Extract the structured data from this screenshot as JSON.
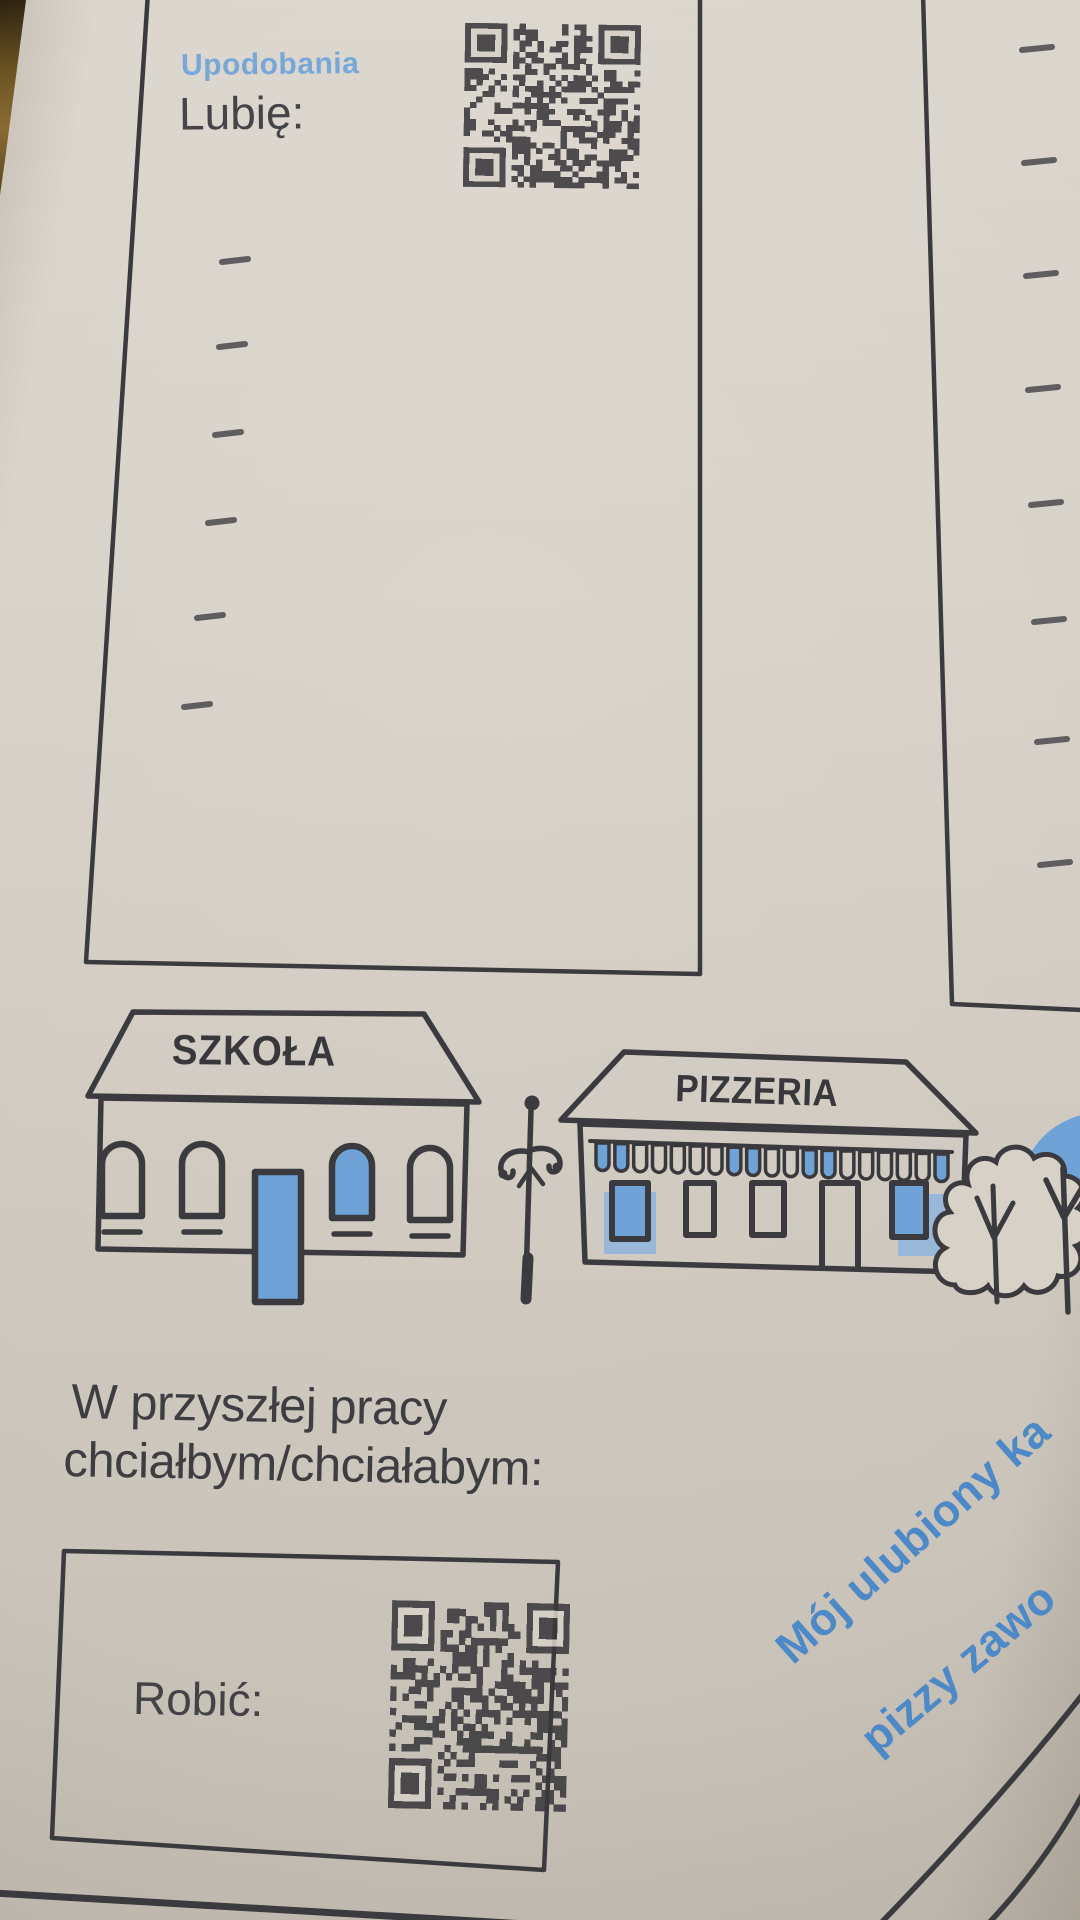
{
  "photo": {
    "paper_color": "#d7d1c8",
    "ink_color": "#39383c",
    "accent_blue": "#6fa2d6",
    "halo_blue": "#8fb5dd",
    "note_blue": "#4d89c6",
    "table_edge_color": "#6d5524"
  },
  "likes_box": {
    "heading": "Upodobania",
    "prompt": "Lubię:",
    "qr_icon": "qr-code",
    "bullets": 6
  },
  "neighbor_box": {
    "bullets": 8
  },
  "street_scene": {
    "school_sign": "SZKOŁA",
    "pizzeria_sign": "PIZZERIA",
    "awning_stripes": 19,
    "awning_blue_stripes": [
      0,
      1,
      7,
      8,
      11,
      12,
      18
    ]
  },
  "job_section": {
    "prompt_line1": "W przyszłej pracy",
    "prompt_line2": "chciałbym/chciałabym:",
    "box_label": "Robić:",
    "qr_icon": "qr-code"
  },
  "diagonal_note": {
    "line1": "Mój ulubiony ka",
    "line2": "pizzy zawo"
  }
}
